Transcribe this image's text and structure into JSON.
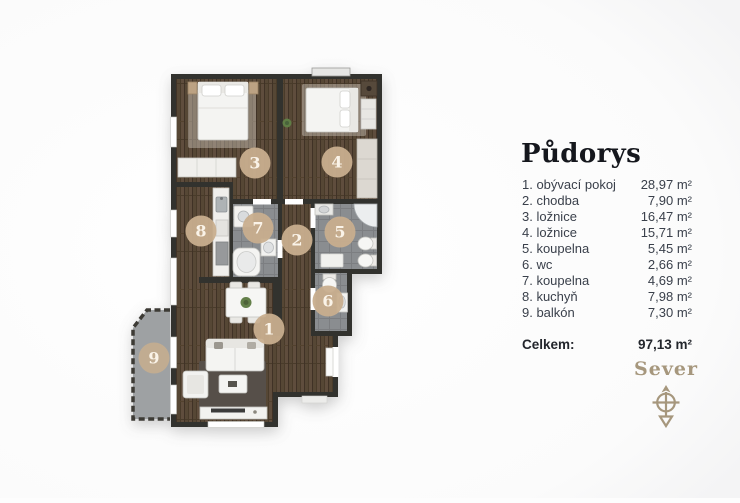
{
  "legend": {
    "title": "Půdorys",
    "rows": [
      {
        "label": "1. obývací pokoj",
        "area": "28,97 m²"
      },
      {
        "label": "2. chodba",
        "area": "7,90 m²"
      },
      {
        "label": "3. ložnice",
        "area": "16,47 m²"
      },
      {
        "label": "4. ložnice",
        "area": "15,71 m²"
      },
      {
        "label": "5. koupelna",
        "area": "5,45 m²"
      },
      {
        "label": "6. wc",
        "area": "2,66 m²"
      },
      {
        "label": "7. koupelna",
        "area": "4,69 m²"
      },
      {
        "label": "8. kuchyň",
        "area": "7,98 m²"
      },
      {
        "label": "9. balkón",
        "area": "7,30 m²"
      }
    ],
    "total_label": "Celkem:",
    "total_area": "97,13 m²"
  },
  "compass": {
    "label": "Sever"
  },
  "floorplan": {
    "room_numbers": [
      "1",
      "2",
      "3",
      "4",
      "5",
      "6",
      "7",
      "8",
      "9"
    ],
    "colors": {
      "wall": "#33312e",
      "wood": "#5f4e3c",
      "tile": "#8a8d90",
      "balcony": "#9ea1a3",
      "badge": "#c8ae8e",
      "badge_text": "#faf3e8",
      "compass": "#a6977d"
    }
  }
}
